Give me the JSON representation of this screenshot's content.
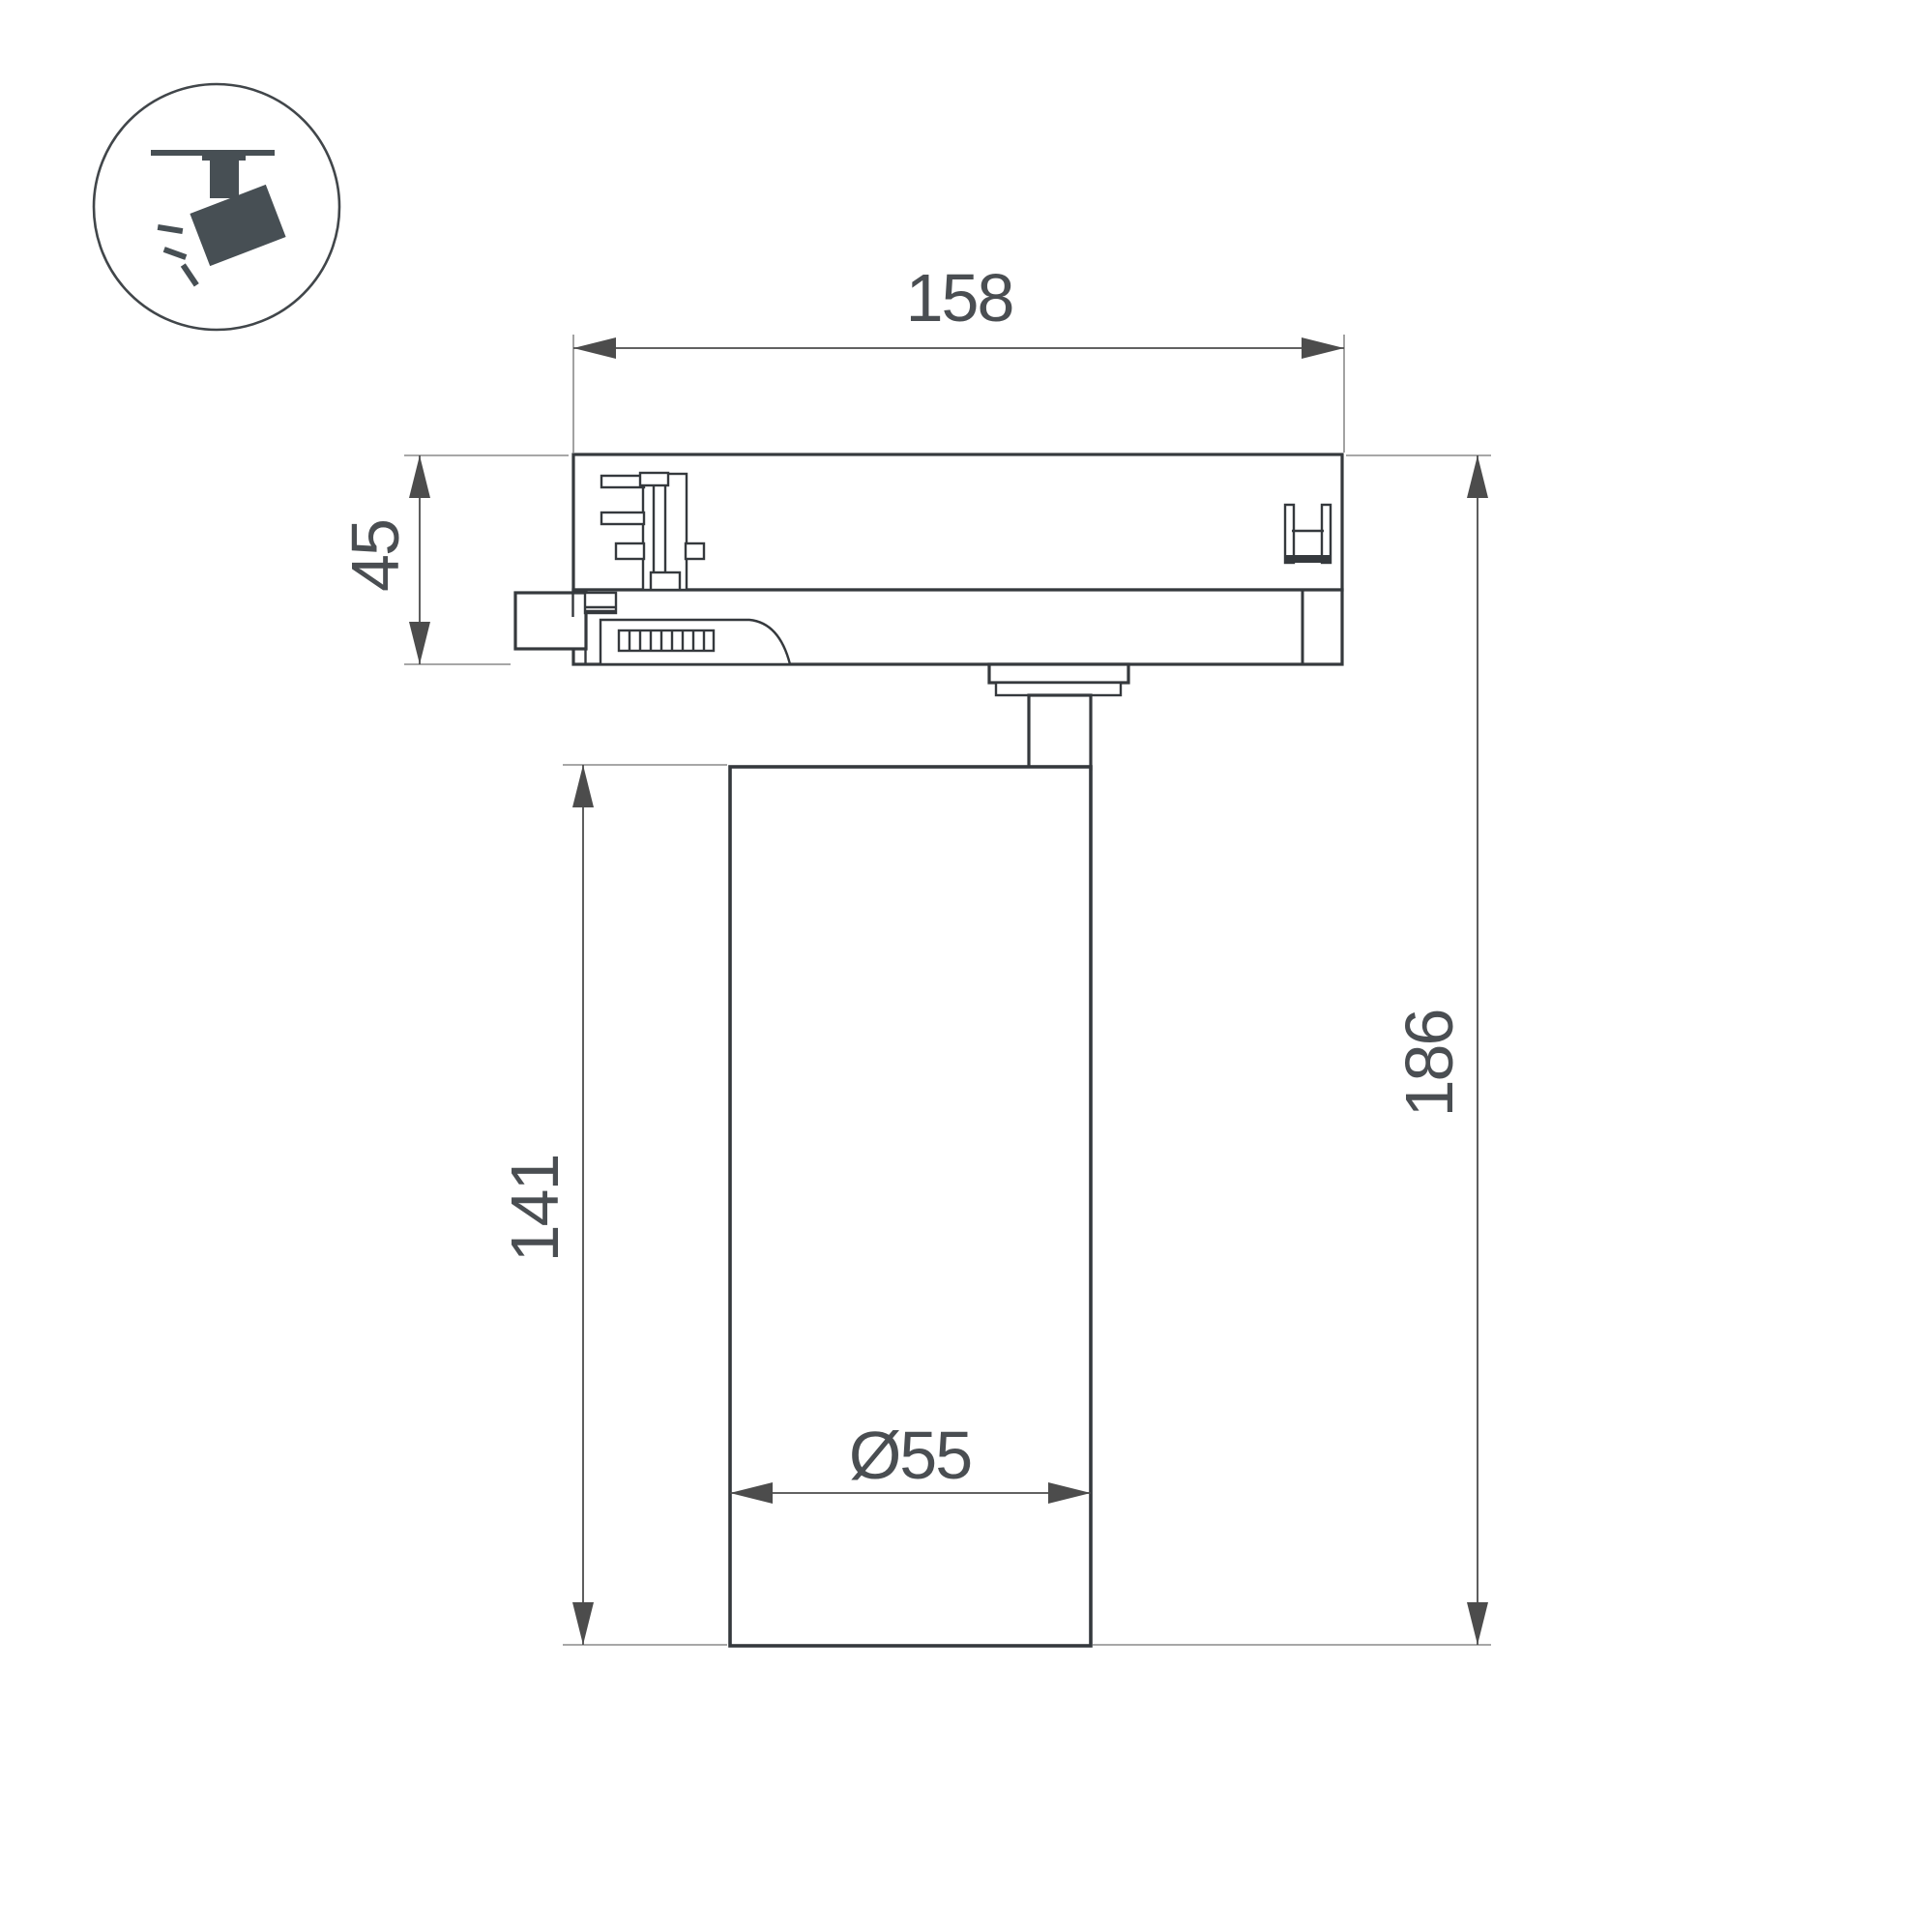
{
  "drawing": {
    "title": "Track spotlight dimensional drawing",
    "badge_icon": "track-spotlight-icon",
    "dimensions": {
      "adapter_width": "158",
      "adapter_height": "45",
      "body_height": "141",
      "total_height": "186",
      "body_diameter": "Ø55"
    },
    "colors": {
      "line_dark": "#35393d",
      "dim_line": "#4c4c4c",
      "ext_line": "#8a8a8a",
      "text": "#4a4e52",
      "icon_fill": "#474f54",
      "background": "#ffffff"
    }
  }
}
